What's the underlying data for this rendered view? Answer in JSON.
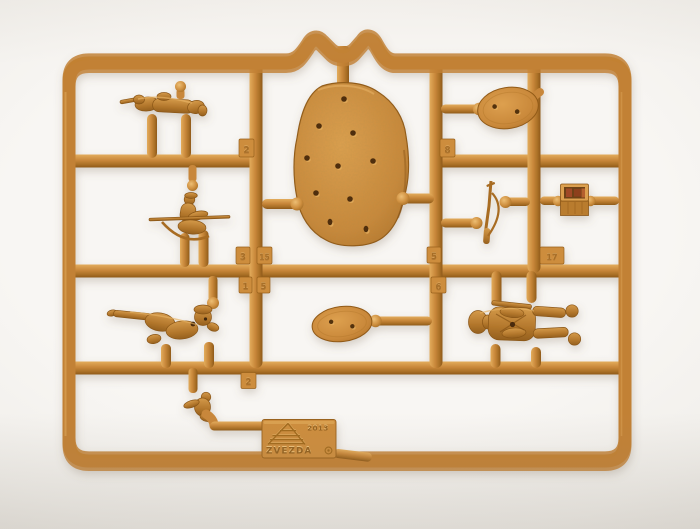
{
  "photo": {
    "subject": "Tan injection-molded plastic model kit sprue with toy-soldier parts on a white surface",
    "brand_plate": {
      "brand": "ZVEZDA",
      "year": "2013",
      "mark": "©"
    },
    "tabs": [
      {
        "number": "2"
      },
      {
        "number": "8"
      },
      {
        "number": "3"
      },
      {
        "number": "15"
      },
      {
        "number": "1"
      },
      {
        "number": "5"
      },
      {
        "number": "5"
      },
      {
        "number": "6"
      },
      {
        "number": "17"
      },
      {
        "number": "2"
      }
    ],
    "colors": {
      "plastic": "#c8873a",
      "plastic_light": "#e1a958",
      "plastic_dark": "#8f5a1a",
      "background": "#f4f2ef",
      "hole": "#4f2f0c",
      "crate_interior": "#a04a26"
    },
    "parts": [
      {
        "name": "prone-rifleman-figure"
      },
      {
        "name": "archer-figure"
      },
      {
        "name": "crawling-soldier-figure"
      },
      {
        "name": "crouching-figure"
      },
      {
        "name": "standing-soldier-figure"
      },
      {
        "name": "musket-with-sling-part"
      },
      {
        "name": "equipment-crate-part"
      },
      {
        "name": "textured-display-base"
      },
      {
        "name": "oval-figure-base",
        "count": 2
      }
    ]
  }
}
